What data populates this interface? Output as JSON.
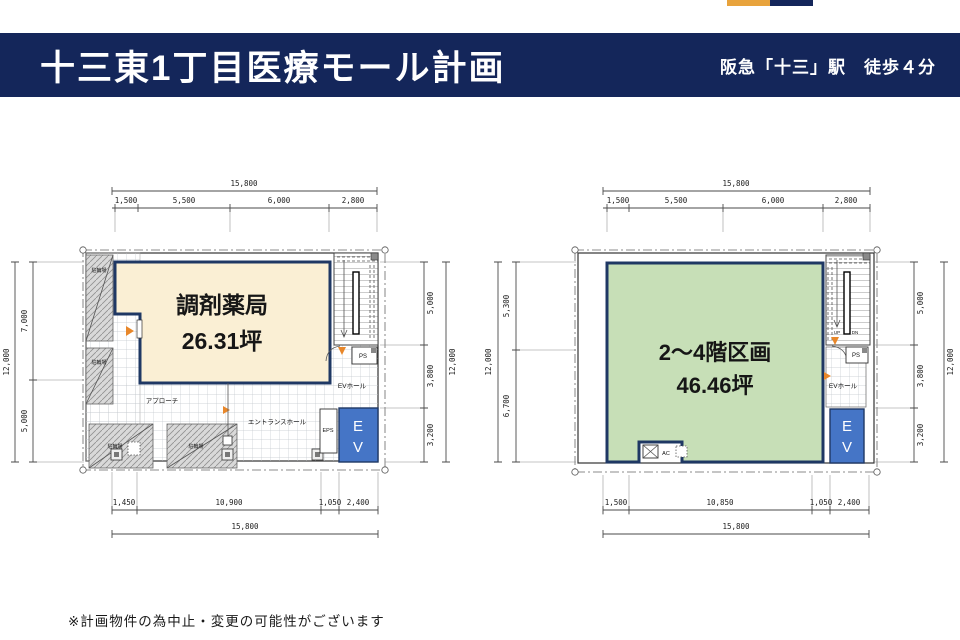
{
  "header": {
    "title": "十三東1丁目医療モール計画",
    "station_access": "阪急「十三」駅　徒歩４分"
  },
  "footer": {
    "disclaimer": "※計画物件の為中止・変更の可能性がございます"
  },
  "colors": {
    "header_navy": "#14265A",
    "accent_orange": "#E8A33C",
    "pharmacy_fill": "#FAEFD4",
    "upper_floor_fill": "#C7DFB7",
    "room_border": "#1F3864",
    "elevator_fill": "#4575C6"
  },
  "plan_left": {
    "room_name": "調剤薬局",
    "room_area": "26.31坪",
    "labels": {
      "bike_parking": "駐輪場",
      "approach": "アプローチ",
      "entrance_hall": "エントランスホール",
      "eps": "EPS",
      "ev_hall": "EVホール",
      "ps": "PS",
      "ev_line1": "E",
      "ev_line2": "V"
    },
    "dims": {
      "top_total": "15,800",
      "top": [
        "1,500",
        "5,500",
        "6,000",
        "2,800"
      ],
      "bottom": [
        "1,450",
        "10,900",
        "1,050",
        "2,400"
      ],
      "bottom_total": "15,800",
      "left": [
        "7,000",
        "5,000"
      ],
      "left_total": "12,000",
      "right": [
        "5,000",
        "3,800",
        "3,200"
      ],
      "right_total": "12,000"
    }
  },
  "plan_right": {
    "room_name": "2〜4階区画",
    "room_area": "46.46坪",
    "labels": {
      "ps": "PS",
      "ev_hall": "EVホール",
      "ev_line1": "E",
      "ev_line2": "V",
      "up": "UP",
      "dn": "DN",
      "ac": "AC"
    },
    "dims": {
      "top_total": "15,800",
      "top": [
        "1,500",
        "5,500",
        "6,000",
        "2,800"
      ],
      "bottom": [
        "1,500",
        "10,850",
        "1,050",
        "2,400"
      ],
      "bottom_total": "15,800",
      "left": [
        "5,300",
        "6,700"
      ],
      "left_total": "12,000",
      "right": [
        "5,000",
        "3,800",
        "3,200"
      ],
      "right_total": "12,000"
    }
  }
}
